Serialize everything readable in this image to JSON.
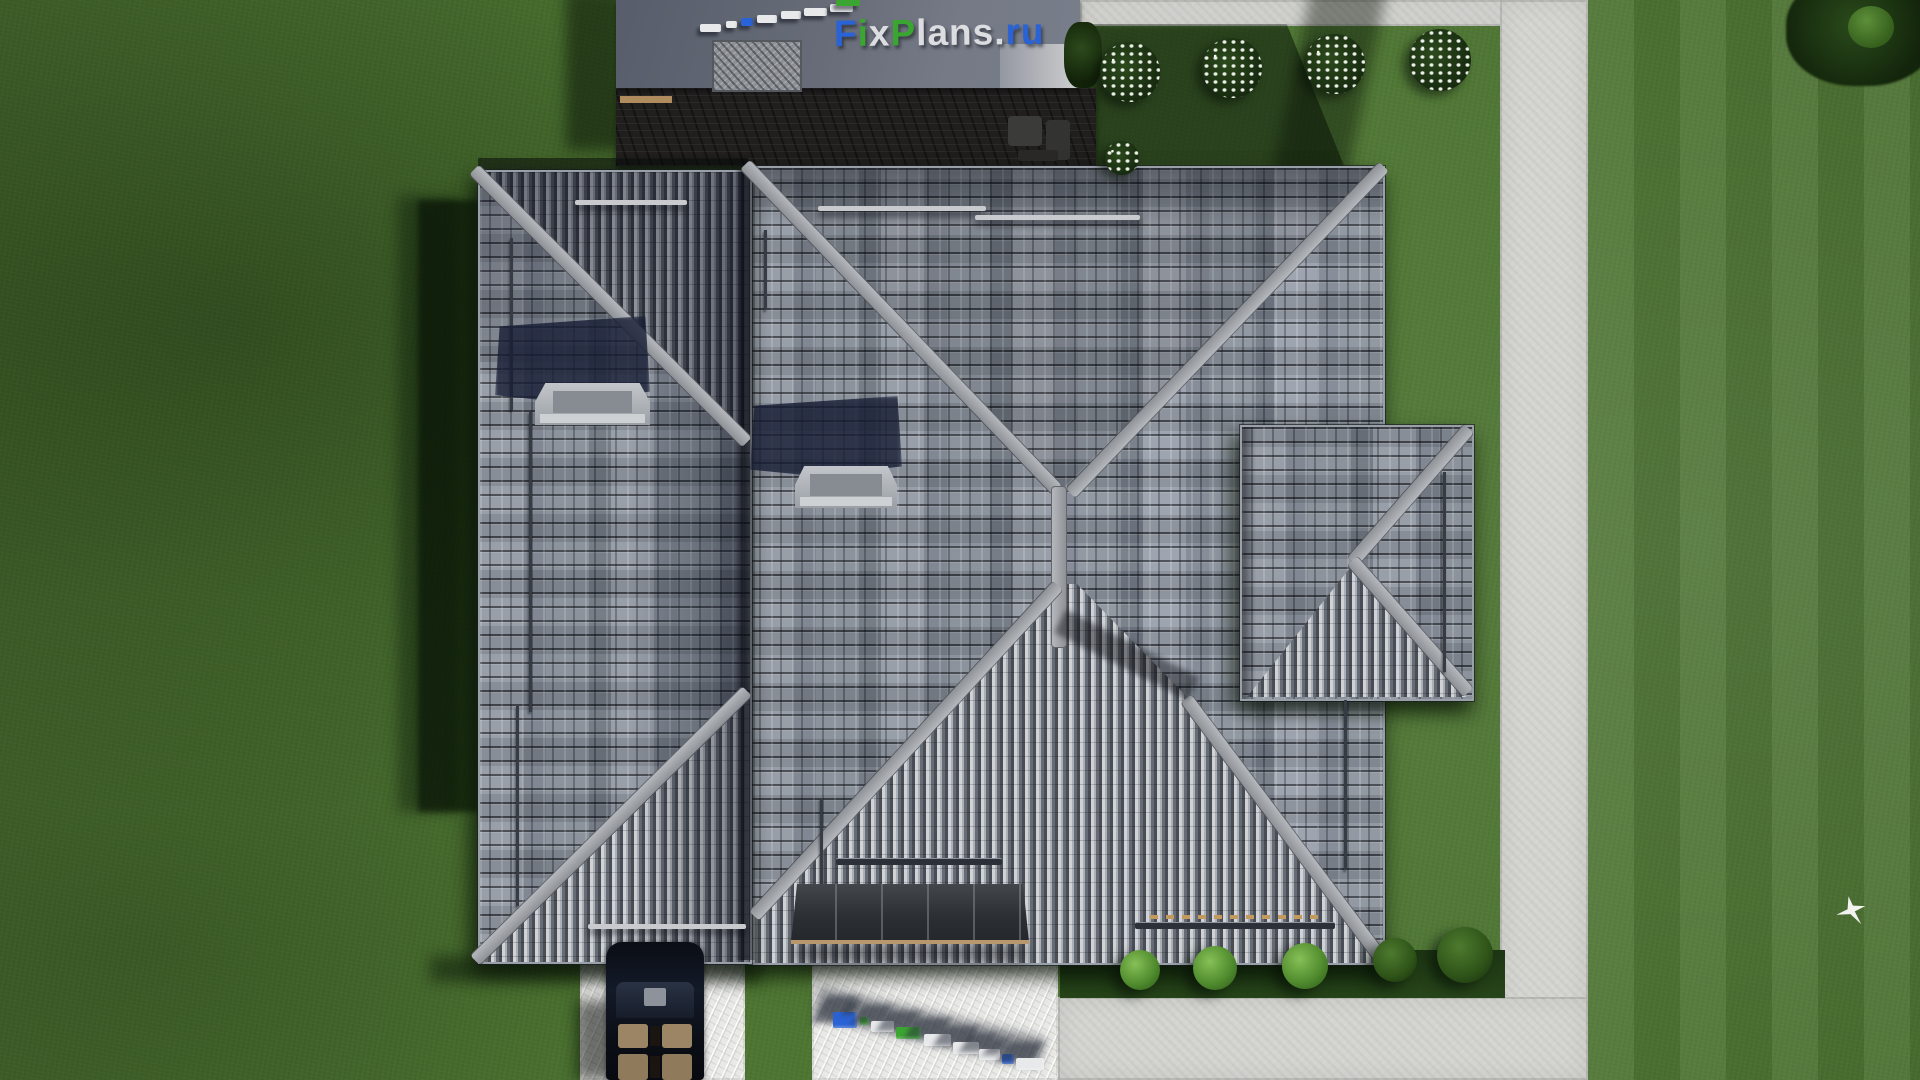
{
  "brand": {
    "logo_text": "FixPlans.ru",
    "letters": [
      {
        "ch": "F",
        "color": "#2a63d6"
      },
      {
        "ch": "i",
        "color": "#3aa530"
      },
      {
        "ch": "x",
        "color": "#dcdde0"
      },
      {
        "ch": "P",
        "color": "#3aa530"
      },
      {
        "ch": "l",
        "color": "#dcdde0"
      },
      {
        "ch": "a",
        "color": "#dcdde0"
      },
      {
        "ch": "n",
        "color": "#dcdde0"
      },
      {
        "ch": "s",
        "color": "#dcdde0"
      },
      {
        "ch": ".",
        "color": "#dcdde0"
      },
      {
        "ch": "r",
        "color": "#2a63d6"
      },
      {
        "ch": "u",
        "color": "#2a63d6"
      }
    ]
  },
  "palette": {
    "blue": "#2a63d6",
    "green": "#3aa530",
    "white": "#e8e9ea",
    "grass": "#4c7331",
    "grass_shadow": "#223d15",
    "pavement": "#d4d5d0",
    "walkway": "#e9e9e6",
    "roof_light": "#949aa4",
    "roof_dark": "#494d55",
    "ridge": "#a8abaf",
    "terrace": "#211f1e",
    "garage_roof": "#6a7080",
    "canopy": "#31353b",
    "canopy_edge": "#b9976c",
    "car_body": "#0d1119",
    "car_seats": "#9c8565"
  },
  "watermark_roof": {
    "blocks": [
      {
        "x": 700,
        "y": 24,
        "w": 21,
        "h": 8,
        "c": "white"
      },
      {
        "x": 726,
        "y": 21,
        "w": 11,
        "h": 7,
        "c": "white"
      },
      {
        "x": 741,
        "y": 18,
        "w": 12,
        "h": 8,
        "c": "blue"
      },
      {
        "x": 757,
        "y": 15,
        "w": 20,
        "h": 8,
        "c": "white"
      },
      {
        "x": 781,
        "y": 11,
        "w": 20,
        "h": 8,
        "c": "white"
      },
      {
        "x": 804,
        "y": 8,
        "w": 23,
        "h": 8,
        "c": "white"
      },
      {
        "x": 830,
        "y": 4,
        "w": 23,
        "h": 8,
        "c": "white"
      },
      {
        "x": 836,
        "y": 0,
        "w": 24,
        "h": 6,
        "c": "green"
      }
    ]
  },
  "watermark_ground": {
    "blocks": [
      {
        "x": 833,
        "y": 1012,
        "w": 24,
        "h": 16,
        "c": "blue"
      },
      {
        "x": 860,
        "y": 1017,
        "w": 9,
        "h": 8,
        "c": "green"
      },
      {
        "x": 871,
        "y": 1021,
        "w": 23,
        "h": 11,
        "c": "white"
      },
      {
        "x": 896,
        "y": 1027,
        "w": 25,
        "h": 12,
        "c": "green"
      },
      {
        "x": 924,
        "y": 1034,
        "w": 27,
        "h": 12,
        "c": "white"
      },
      {
        "x": 953,
        "y": 1042,
        "w": 26,
        "h": 12,
        "c": "white"
      },
      {
        "x": 979,
        "y": 1049,
        "w": 21,
        "h": 11,
        "c": "white"
      },
      {
        "x": 1002,
        "y": 1054,
        "w": 12,
        "h": 10,
        "c": "blue"
      },
      {
        "x": 1016,
        "y": 1058,
        "w": 28,
        "h": 12,
        "c": "white"
      }
    ]
  },
  "landscape": {
    "north_bushes": [
      {
        "x": 1130,
        "y": 72,
        "r": 30
      },
      {
        "x": 1232,
        "y": 68,
        "r": 30
      },
      {
        "x": 1335,
        "y": 64,
        "r": 30
      },
      {
        "x": 1440,
        "y": 60,
        "r": 31
      },
      {
        "x": 1122,
        "y": 158,
        "r": 17
      }
    ],
    "south_bushes": [
      {
        "x": 1140,
        "y": 970,
        "r": 20,
        "tone": "bright"
      },
      {
        "x": 1215,
        "y": 968,
        "r": 22,
        "tone": "bright"
      },
      {
        "x": 1305,
        "y": 966,
        "r": 23,
        "tone": "bright"
      },
      {
        "x": 1395,
        "y": 960,
        "r": 22,
        "tone": "dark"
      },
      {
        "x": 1465,
        "y": 955,
        "r": 28,
        "tone": "dark"
      }
    ]
  }
}
